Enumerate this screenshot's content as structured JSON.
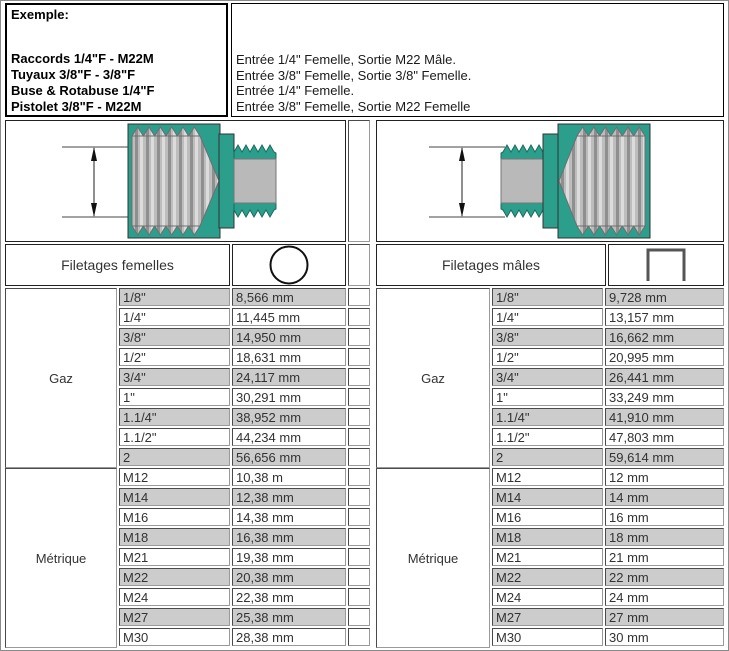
{
  "example": {
    "title": "Exemple:",
    "lines": [
      "Raccords 1/4\"F - M22M",
      "Tuyaux 3/8\"F - 3/8\"F",
      "Buse & Rotabuse 1/4\"F",
      "Pistolet 3/8\"F - M22M"
    ]
  },
  "descriptions": [
    "Entrée 1/4\" Femelle, Sortie M22 Mâle.",
    "Entrée 3/8\" Femelle, Sortie 3/8\" Femelle.",
    "Entrée 1/4\" Femelle.",
    "Entrée 3/8\" Femelle, Sortie M22 Femelle"
  ],
  "female_table": {
    "header": "Filetages femelles",
    "icon": "circle-icon",
    "gaz": {
      "label": "Gaz",
      "rows": [
        {
          "size": "1/8\"",
          "value": "8,566 mm"
        },
        {
          "size": "1/4\"",
          "value": "11,445 mm"
        },
        {
          "size": "3/8\"",
          "value": "14,950 mm"
        },
        {
          "size": "1/2\"",
          "value": "18,631 mm"
        },
        {
          "size": "3/4\"",
          "value": "24,117 mm"
        },
        {
          "size": "1\"",
          "value": "30,291 mm"
        },
        {
          "size": "1.1/4\"",
          "value": "38,952 mm"
        },
        {
          "size": "1.1/2\"",
          "value": "44,234 mm"
        },
        {
          "size": "2",
          "value": "56,656 mm"
        }
      ]
    },
    "metrique": {
      "label": "Métrique",
      "rows": [
        {
          "size": "M12",
          "value": "10,38 m"
        },
        {
          "size": "M14",
          "value": "12,38 mm"
        },
        {
          "size": "M16",
          "value": "14,38 mm"
        },
        {
          "size": "M18",
          "value": "16,38 mm"
        },
        {
          "size": "M21",
          "value": "19,38 mm"
        },
        {
          "size": "M22",
          "value": "20,38 mm"
        },
        {
          "size": "M24",
          "value": "22,38 mm"
        },
        {
          "size": "M27",
          "value": "25,38 mm"
        },
        {
          "size": "M30",
          "value": "28,38 mm"
        }
      ]
    }
  },
  "male_table": {
    "header": "Filetages mâles",
    "icon": "open-square-icon",
    "gaz": {
      "label": "Gaz",
      "rows": [
        {
          "size": "1/8\"",
          "value": "9,728 mm"
        },
        {
          "size": "1/4\"",
          "value": "13,157 mm"
        },
        {
          "size": "3/8\"",
          "value": "16,662 mm"
        },
        {
          "size": "1/2\"",
          "value": "20,995 mm"
        },
        {
          "size": "3/4\"",
          "value": "26,441 mm"
        },
        {
          "size": "1\"",
          "value": "33,249 mm"
        },
        {
          "size": "1.1/4\"",
          "value": "41,910 mm"
        },
        {
          "size": "1.1/2\"",
          "value": "47,803 mm"
        },
        {
          "size": "2",
          "value": "59,614 mm"
        }
      ]
    },
    "metrique": {
      "label": "Métrique",
      "rows": [
        {
          "size": "M12",
          "value": "12 mm"
        },
        {
          "size": "M14",
          "value": "14 mm"
        },
        {
          "size": "M16",
          "value": "16 mm"
        },
        {
          "size": "M18",
          "value": "18 mm"
        },
        {
          "size": "M21",
          "value": "21 mm"
        },
        {
          "size": "M22",
          "value": "22 mm"
        },
        {
          "size": "M24",
          "value": "24 mm"
        },
        {
          "size": "M27",
          "value": "27 mm"
        },
        {
          "size": "M30",
          "value": "30 mm"
        }
      ]
    }
  },
  "colors": {
    "fitting_teal": "#2b9e8c",
    "thread_gray": "#b9b9b9",
    "row_shade": "#cccccc"
  }
}
